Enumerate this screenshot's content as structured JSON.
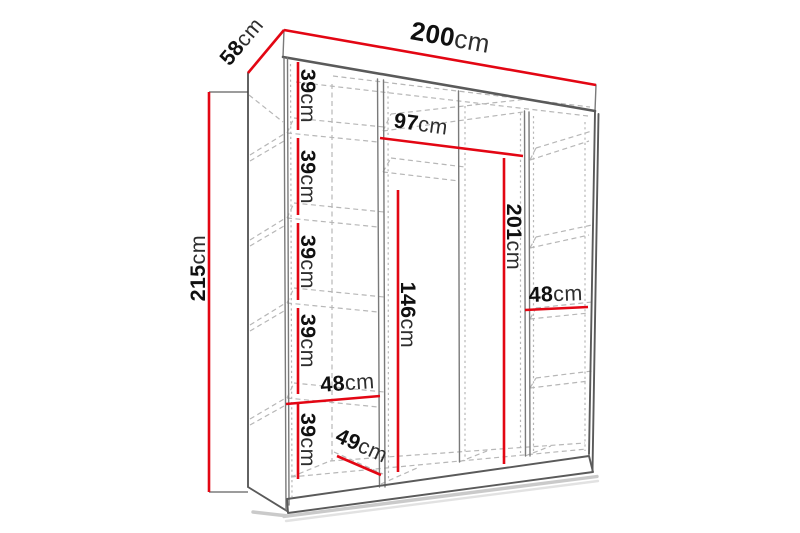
{
  "figure": "wardrobe-interior-dimension-diagram",
  "colors": {
    "red": "#e30613",
    "line": "#7a7a7a",
    "thick": "#5a5a5a",
    "dash": "#b7b7b7",
    "text": "#101010",
    "unit": "#2e2e2e"
  },
  "dims": {
    "width": {
      "num": "200",
      "unit": "cm"
    },
    "depth": {
      "num": "58",
      "unit": "cm"
    },
    "height": {
      "num": "215",
      "unit": "cm"
    },
    "shelf1": {
      "num": "39",
      "unit": "cm"
    },
    "shelf2": {
      "num": "39",
      "unit": "cm"
    },
    "shelf3": {
      "num": "39",
      "unit": "cm"
    },
    "shelf4": {
      "num": "39",
      "unit": "cm"
    },
    "shelf5": {
      "num": "39",
      "unit": "cm"
    },
    "left_width": {
      "num": "48",
      "unit": "cm"
    },
    "floor_depth": {
      "num": "49",
      "unit": "cm"
    },
    "middle_width": {
      "num": "97",
      "unit": "cm"
    },
    "middle_height": {
      "num": "201",
      "unit": "cm"
    },
    "hanging_height": {
      "num": "146",
      "unit": "cm"
    },
    "right_width": {
      "num": "48",
      "unit": "cm"
    }
  }
}
